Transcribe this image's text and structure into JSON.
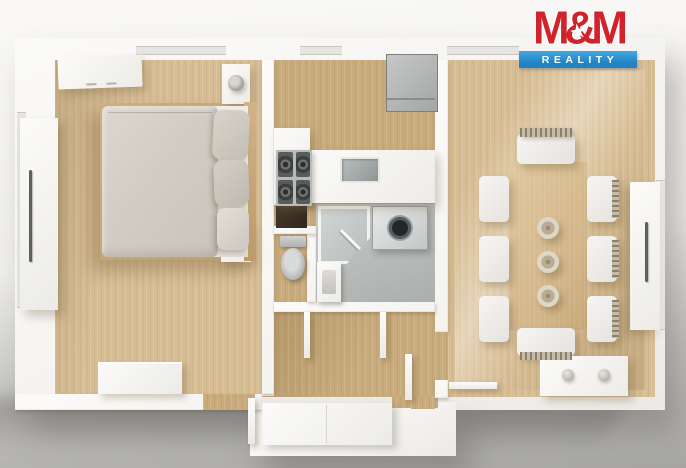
{
  "brand_logo": {
    "title": "M&M",
    "star": "★",
    "subtitle": "REALITY"
  },
  "palette": {
    "bg_top": "#faf9f7",
    "bg_bottom": "#a7a6a3",
    "wall": "#f4f3f0",
    "wood": "#d7bd94",
    "wood_dark": "#c8ab7c",
    "tile": "#b5b9b7",
    "appliance_gray": "#a3a6a5",
    "logo_red": "#d0232c",
    "logo_blue": "#1f83c4"
  }
}
